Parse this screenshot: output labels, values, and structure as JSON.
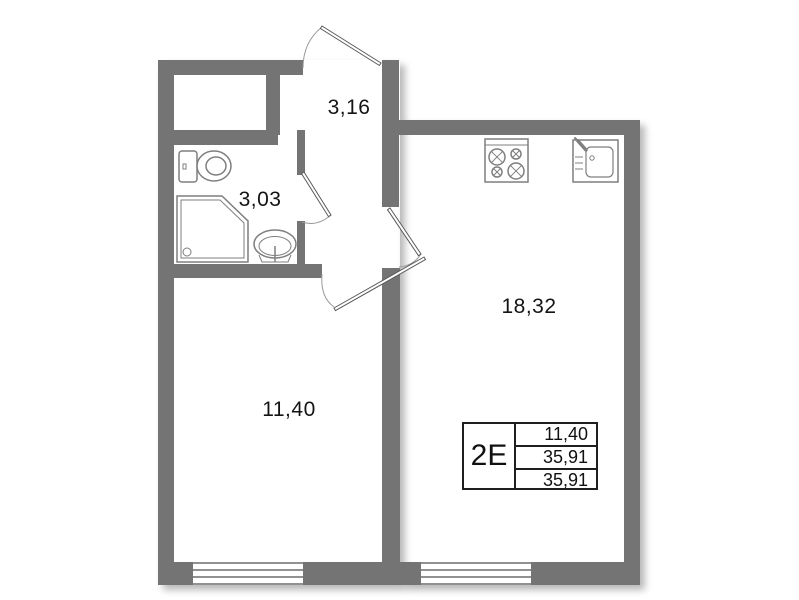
{
  "rooms": {
    "hallway": {
      "area": "3,16"
    },
    "bathroom": {
      "area": "3,03"
    },
    "kitchen_living": {
      "area": "18,32"
    },
    "bedroom": {
      "area": "11,40"
    }
  },
  "info_table": {
    "unit_type": "2E",
    "rows": [
      "11,40",
      "35,91",
      "35,91"
    ]
  },
  "fixtures": {
    "bathroom": [
      "toilet-icon",
      "shower-icon",
      "sink-icon"
    ],
    "kitchen": [
      "stove-icon",
      "kitchen-sink-icon"
    ]
  },
  "colors": {
    "wall": "#747474",
    "fixture_line": "#7f7f7f",
    "door_line": "#5a5a5a",
    "window_line": "#4f4f4f",
    "text": "#141414"
  }
}
